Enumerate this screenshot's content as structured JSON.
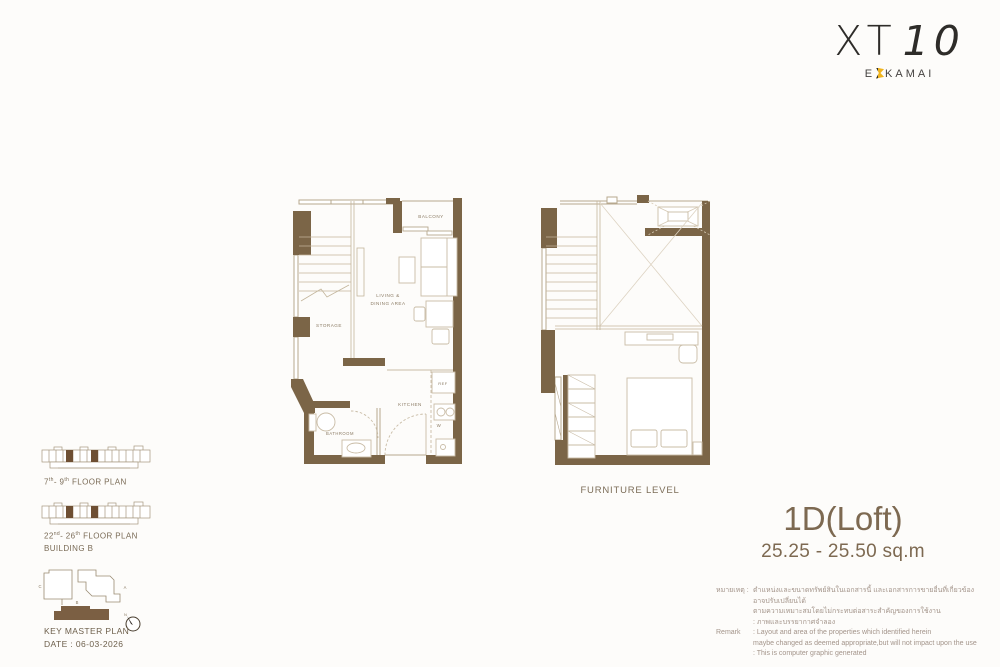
{
  "logo": {
    "brand": "XT",
    "number": "10",
    "sub_left": "E",
    "sub_right": "KAMAI"
  },
  "plans": {
    "living": {
      "balcony": "BALCONY",
      "storage": "STORAGE",
      "living_1": "LIVING &",
      "living_2": "DINING AREA",
      "kitchen": "KITCHEN",
      "bathroom": "BATHROOM",
      "ref": "REF",
      "washer": "W"
    },
    "furniture": {
      "caption": "FURNITURE LEVEL"
    }
  },
  "unit": {
    "name": "1D(Loft)",
    "area": "25.25 - 25.50 sq.m"
  },
  "remark": {
    "thai_label": "หมายเหตุ :",
    "thai_lines": [
      "ตำแหน่งและขนาดทรัพย์สินในเอกสารนี้ และเอกสารการขายอื่นที่เกี่ยวข้อง อาจปรับเปลี่ยนได้",
      "ตามความเหมาะสมโดยไม่กระทบต่อสาระสำคัญของการใช้งาน",
      ": ภาพและบรรยากาศจำลอง"
    ],
    "en_label": "Remark",
    "en_lines": [
      ": Layout and area of the properties which identified herein",
      "maybe changed as deemed appropriate,but will not impact upon the use",
      ": This is computer graphic generated"
    ]
  },
  "key_plans": {
    "plan_a": {
      "n1": "7",
      "s1": "th",
      "n2": "- 9",
      "s2": "th",
      "rest": " FLOOR PLAN"
    },
    "plan_b": {
      "n1": "22",
      "s1": "nd",
      "n2": "- 26",
      "s2": "th",
      "rest": " FLOOR PLAN",
      "building": "BUILDING B"
    },
    "master": {
      "title": "KEY MASTER PLAN",
      "date": "DATE : 06-03-2026",
      "bldg_a": "A",
      "bldg_b": "B",
      "bldg_c": "C",
      "north": "N"
    }
  },
  "colors": {
    "wall": "#7b6547",
    "accent_gold": "#f0b41e",
    "title_brown": "#7d6951"
  }
}
